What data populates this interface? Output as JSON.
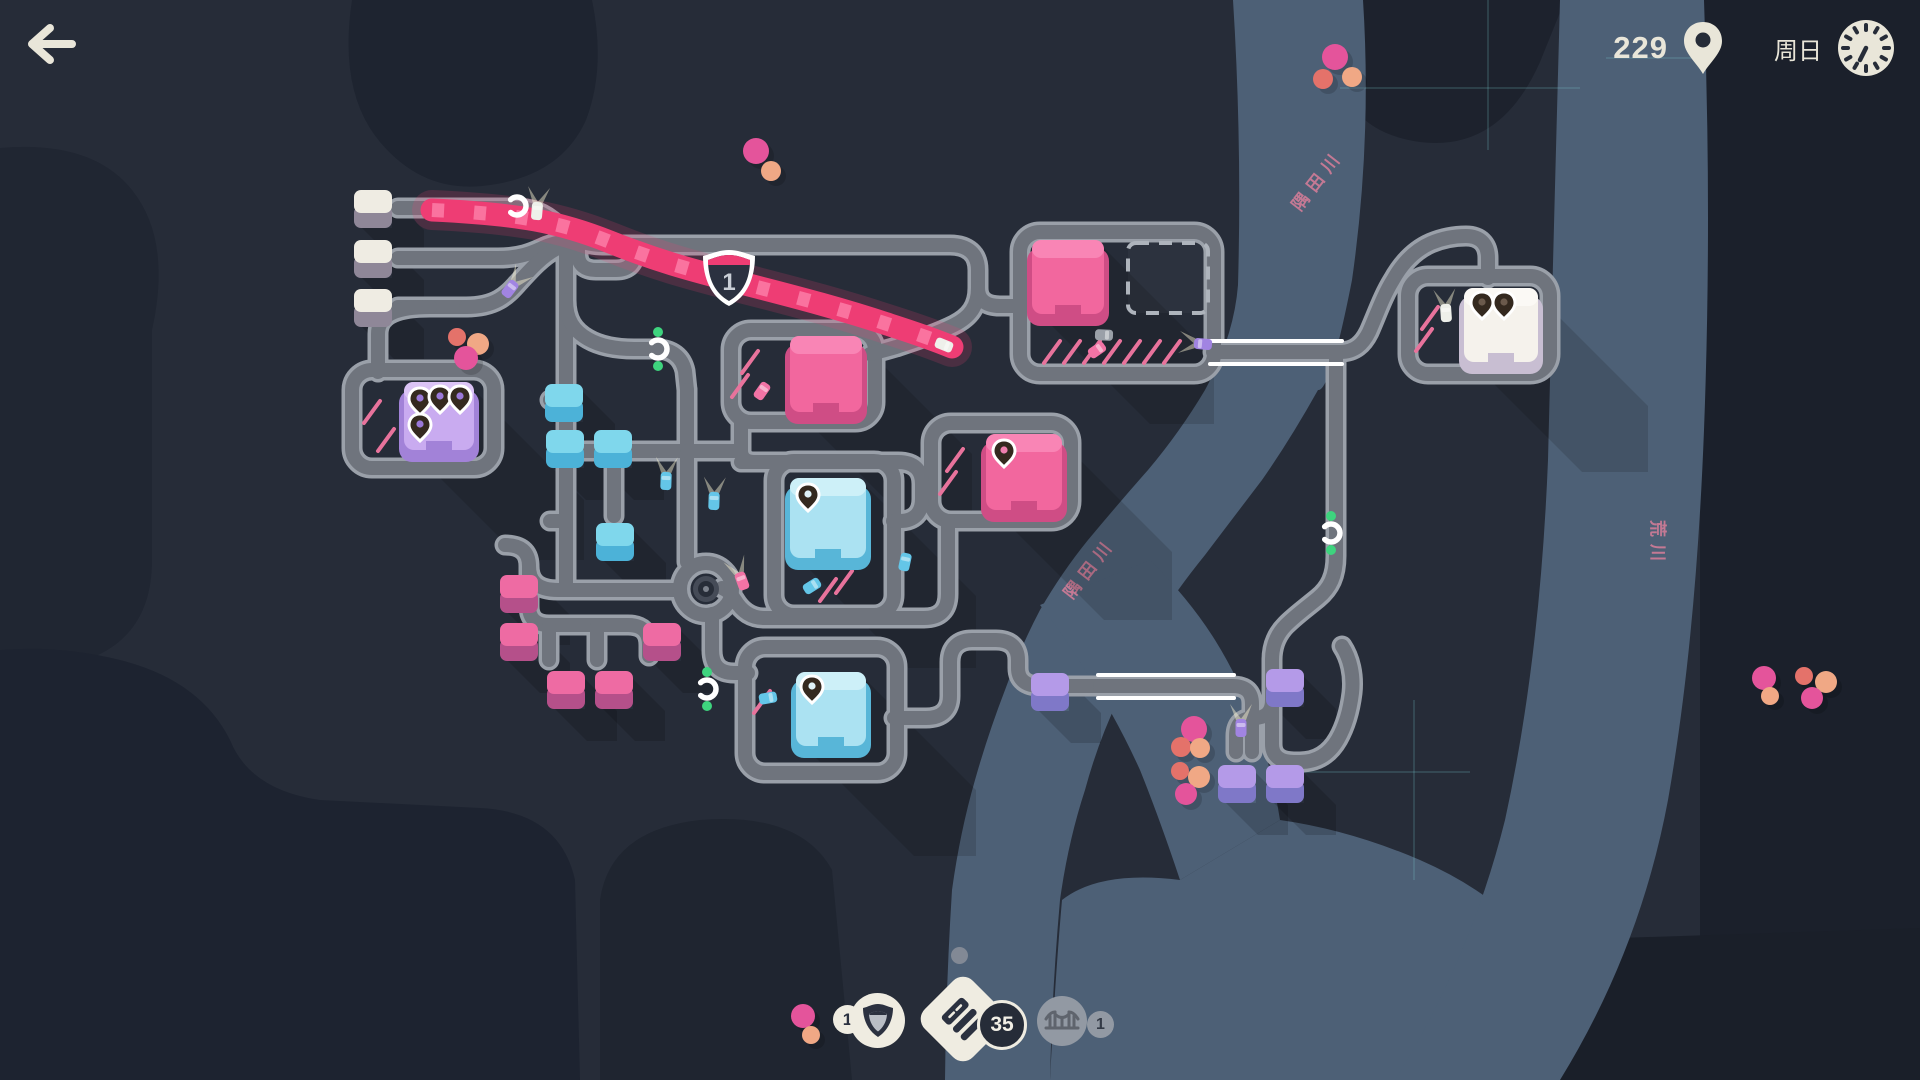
{
  "hud": {
    "score": "229",
    "day": "周日"
  },
  "inventory": {
    "motorway_count": "1",
    "road_count": "35",
    "bridge_count": "1"
  },
  "map": {
    "colors": {
      "bg": "#262c38",
      "road_edge": "#9aa0a9",
      "road_fill": "#6f747d",
      "river": "#4d6076",
      "motorway": "#ee3d74",
      "motorway_stripe": "#ff8ab2",
      "curb": "#ffffff",
      "grid": "#7fd9dd",
      "label": "#e2809c",
      "green": "#3ed47e",
      "dot_pink": "#e4549b",
      "dot_salmon": "#e4726a",
      "dot_peach": "#f0a885"
    },
    "bg_patches": [
      {
        "d": "M352 0 Q338 92 380 142 Q422 192 482 186 Q560 178 586 120 Q606 68 592 0 Z",
        "f": "#1e2430"
      },
      {
        "d": "M0 148 Q92 140 132 190 Q172 240 152 330 L152 560 Q152 640 80 662 L0 682 Z",
        "f": "#202632"
      },
      {
        "d": "M0 650 Q60 645 120 660 Q200 680 230 740 Q250 790 320 800 L480 808 Q560 812 575 880 L580 1080 L0 1080 Z",
        "f": "#1d2330"
      },
      {
        "d": "M600 1080 L600 900 Q610 830 700 820 Q800 812 832 870 L852 1080 Z",
        "f": "#1f2530"
      },
      {
        "d": "M1336 0 L1565 0 L1540 62 Q1500 152 1420 142 Q1348 132 1340 70 Z",
        "f": "#1d222d"
      },
      {
        "d": "M1700 0 H1920 V1080 H1700 Z",
        "f": "#1b202b"
      },
      {
        "d": "M1430 1080 Q1520 1000 1560 940 L1920 928 V1080 Z",
        "f": "#1a1f29"
      }
    ],
    "rivers": [
      {
        "d": "M1233 0 L1363 0 Q1372 140 1352 280 Q1330 392 1318 390 Q1290 440 1262 480 Q1230 522 1205 555 Q1175 592 1155 625 Q1132 662 1118 700 Q1098 742 1085 790 Q1068 842 1060 900 Q1052 990 1050 1080 L945 1080 Q946 985 952 890 Q960 832 975 780 Q988 734 1005 690 Q1020 648 1040 610 Q1062 572 1088 540 Q1118 504 1148 470 Q1180 432 1205 390 Q1234 336 1238 285 Q1242 142 1233 0 Z"
      },
      {
        "d": "M1150 560 Q1190 600 1215 640 Q1240 680 1258 730 Q1272 770 1280 820 L1180 880 Q1160 820 1140 770 Q1115 715 1085 670 Q1060 630 1040 605 Z"
      },
      {
        "d": "M1280 820 Q1350 830 1420 860 Q1500 895 1540 950 Q1490 1020 1430 1080 L1050 1080 Q1055 980 1062 900 Q1100 870 1180 880 Z"
      },
      {
        "d": "M1560 0 H1704 Q1712 220 1704 430 Q1696 640 1668 800 Q1640 950 1560 1080 L1395 1080 Q1470 960 1505 820 Q1540 660 1548 460 Q1554 220 1560 0 Z"
      }
    ],
    "grid_lines": [
      [
        1488,
        0,
        1488,
        150
      ],
      [
        1340,
        88,
        1580,
        88
      ],
      [
        1414,
        700,
        1414,
        880
      ],
      [
        1300,
        772,
        1470,
        772
      ],
      [
        1606,
        58,
        1712,
        58
      ]
    ],
    "river_labels": [
      {
        "text": "隅田川",
        "x": 1300,
        "y": 212,
        "rot": -52
      },
      {
        "text": "隅田川",
        "x": 1072,
        "y": 600,
        "rot": -52
      },
      {
        "text": "荒川",
        "x": 1652,
        "y": 520,
        "rot": 90
      }
    ],
    "roads": [
      "M 398 208 H 514",
      "M 398 258 H 498",
      "M 398 307 H 466",
      "M 514 208 C 544 208 554 223 568 234 C 580 243 592 245 604 245",
      "M 498 258 C 524 258 535 251 547 246 C 558 242 566 241 578 242",
      "M 466 307 C 496 307 507 295 517 284 C 529 271 541 257 556 249",
      "M 430 307 C 400 307 378 313 378 334 L 378 372",
      "M 604 245 H 950 C 968 245 978 254 978 270 V 288 C 978 306 970 317 954 325 C 936 334 914 341 896 347 C 886 350 878 352 870 354",
      "M 978 288 C 978 300 986 306 1000 306 L 1022 306",
      "M 578 245 V 254 C 578 265 585 270 596 270 H 616 C 628 270 634 264 634 254 V 246",
      "M 566 240 V 585",
      "M 566 300 C 566 320 574 331 588 339 C 602 347 618 349 634 349 H 656 C 672 349 682 357 685 371 L 687 390",
      "M 566 451 H 687",
      "M 687 390 V 562",
      "M 741 420 V 450 C 741 458 746 462 754 462",
      "M 566 400 H 550",
      "M 566 521 H 550",
      "M 614 451 V 516",
      "M 687 451 H 741",
      "M 741 462 H 898 C 914 462 922 470 922 484 V 499 C 922 513 914 521 900 521 L 893 521",
      "M 948 521 V 594 C 948 610 940 618 924 618 H 764 C 750 618 741 610 735 600 C 731 594 727 590 722 588",
      "M 712 614 V 650 C 712 666 720 673 734 673 L 748 673",
      "M 680 590 H 558 C 537 590 529 581 529 566 C 529 551 520 545 505 545",
      "M 529 566 V 606 C 529 619 536 625 549 625 H 628 C 642 625 649 632 649 645 L 649 656",
      "M 549 625 V 660",
      "M 597 625 V 660",
      "M 1213 352 H 1340",
      "M 1340 352 C 1355 352 1363 344 1369 332 C 1377 314 1383 296 1393 280 C 1403 262 1415 250 1431 243 C 1443 238 1455 236 1466 236 C 1480 236 1488 244 1488 258 L 1488 278",
      "M 1336 352 V 556 C 1336 576 1330 588 1318 598 C 1306 608 1296 615 1286 625 C 1276 635 1272 647 1272 660",
      "M 1272 660 V 744 C 1272 756 1280 762 1294 762 H 1300 C 1318 762 1330 753 1338 739 C 1346 725 1350 709 1352 693 C 1354 675 1350 658 1342 646",
      "M 1272 700 C 1272 712 1266 718 1254 718 C 1242 718 1236 724 1236 736 V 752",
      "M 894 718 H 926 C 942 718 950 710 950 696 V 662 C 950 648 958 640 972 640 H 996 C 1010 640 1018 647 1018 660 V 668 C 1018 680 1026 686 1040 686 H 1100",
      "M 1100 686 H 1232",
      "M 1232 686 C 1246 686 1252 692 1252 704 V 752"
    ],
    "lots": [
      [
        352,
        370,
        142,
        98
      ],
      [
        731,
        330,
        144,
        92
      ],
      [
        931,
        423,
        140,
        98
      ],
      [
        1020,
        232,
        194,
        142
      ],
      [
        774,
        461,
        120,
        154
      ],
      [
        745,
        647,
        152,
        126
      ],
      [
        1408,
        276,
        142,
        98
      ]
    ],
    "bridges": [
      [
        1210,
        341,
        1342,
        341
      ],
      [
        1210,
        364,
        1342,
        364
      ],
      [
        1098,
        675,
        1234,
        675
      ],
      [
        1098,
        698,
        1234,
        698
      ]
    ],
    "motorway": {
      "path": "M 432 210 C 520 214 560 222 610 242 C 665 264 700 272 745 284 C 800 298 845 310 890 325 C 915 333 935 340 952 347",
      "shield": {
        "x": 729,
        "y": 277,
        "label": "1"
      }
    },
    "dashed_zone": {
      "x": 1128,
      "y": 243,
      "w": 80,
      "h": 70
    },
    "deco_dashes": [
      [
        372,
        412
      ],
      [
        386,
        440
      ],
      [
        750,
        362
      ],
      [
        740,
        386
      ],
      [
        955,
        460
      ],
      [
        948,
        483
      ],
      [
        1052,
        352
      ],
      [
        1072,
        352
      ],
      [
        1092,
        352
      ],
      [
        1112,
        352
      ],
      [
        1132,
        352
      ],
      [
        1152,
        352
      ],
      [
        1172,
        352
      ],
      [
        1430,
        318
      ],
      [
        1424,
        340
      ],
      [
        828,
        590
      ],
      [
        844,
        582
      ],
      [
        762,
        702
      ]
    ],
    "roundabout": {
      "x": 706,
      "y": 589
    },
    "houses": [
      [
        354,
        190,
        "gray"
      ],
      [
        354,
        240,
        "gray"
      ],
      [
        354,
        289,
        "gray"
      ],
      [
        545,
        384,
        "blue"
      ],
      [
        546,
        430,
        "blue"
      ],
      [
        594,
        430,
        "blue"
      ],
      [
        596,
        523,
        "blue"
      ],
      [
        500,
        575,
        "pink"
      ],
      [
        500,
        623,
        "pink"
      ],
      [
        547,
        671,
        "pink"
      ],
      [
        595,
        671,
        "pink"
      ],
      [
        643,
        623,
        "pink"
      ],
      [
        1031,
        673,
        "purple"
      ],
      [
        1266,
        669,
        "purple"
      ],
      [
        1218,
        765,
        "purple"
      ],
      [
        1266,
        765,
        "purple"
      ]
    ],
    "house_palette": {
      "gray": [
        "#efece3",
        "#8f8798"
      ],
      "blue": [
        "#7fd7ec",
        "#4cb2d8"
      ],
      "pink": [
        "#ee6ba3",
        "#b5508a"
      ],
      "purple": [
        "#b49ae8",
        "#7f78c8"
      ]
    },
    "destinations": [
      {
        "x": 404,
        "y": 382,
        "w": 70,
        "h": 68,
        "face": "#c9abf0",
        "top": "#dbc4f6",
        "side": "#a282d8",
        "hole": "#9a78d8",
        "pins": [
          [
            16,
            18
          ],
          [
            36,
            16
          ],
          [
            56,
            16
          ],
          [
            16,
            44
          ]
        ]
      },
      {
        "x": 790,
        "y": 336,
        "w": 72,
        "h": 76,
        "face": "#f2679e",
        "top": "#f985b5",
        "side": "#cf4d85",
        "hole": "#ef7fae",
        "pins": []
      },
      {
        "x": 986,
        "y": 434,
        "w": 76,
        "h": 76,
        "face": "#f2679e",
        "top": "#f985b5",
        "side": "#cf4d85",
        "hole": "#ef7fae",
        "pins": [
          [
            18,
            18
          ]
        ]
      },
      {
        "x": 1032,
        "y": 240,
        "w": 72,
        "h": 74,
        "face": "#f2679e",
        "top": "#f985b5",
        "side": "#cf4d85",
        "hole": "#ef7fae",
        "pins": []
      },
      {
        "x": 790,
        "y": 478,
        "w": 76,
        "h": 80,
        "face": "#abe2f2",
        "top": "#cdf0f8",
        "side": "#58b6d8",
        "hole": "#dff2f8",
        "pins": [
          [
            18,
            18
          ]
        ]
      },
      {
        "x": 796,
        "y": 672,
        "w": 70,
        "h": 74,
        "face": "#abe2f2",
        "top": "#cdf0f8",
        "side": "#58b6d8",
        "hole": "#dff2f8",
        "pins": [
          [
            16,
            16
          ]
        ]
      },
      {
        "x": 1464,
        "y": 288,
        "w": 74,
        "h": 74,
        "face": "#f5f2ec",
        "top": "#fbf9f5",
        "side": "#c8bed2",
        "hole": "#6b5a4c",
        "pins": [
          [
            18,
            16
          ],
          [
            40,
            16
          ]
        ]
      }
    ],
    "cars": [
      [
        537,
        211,
        5,
        "white",
        1
      ],
      [
        510,
        289,
        38,
        "purple",
        1
      ],
      [
        944,
        345,
        112,
        "white",
        0
      ],
      [
        1104,
        335,
        92,
        "gray",
        0
      ],
      [
        1097,
        350,
        55,
        "pink",
        0
      ],
      [
        1203,
        344,
        -85,
        "purple",
        1
      ],
      [
        666,
        481,
        2,
        "blue",
        1
      ],
      [
        714,
        501,
        2,
        "blue",
        1
      ],
      [
        762,
        391,
        35,
        "pink",
        0
      ],
      [
        742,
        581,
        -20,
        "pink",
        1
      ],
      [
        905,
        562,
        12,
        "blue",
        0
      ],
      [
        812,
        586,
        58,
        "blue",
        0
      ],
      [
        1446,
        313,
        -4,
        "white",
        1
      ],
      [
        1241,
        728,
        0,
        "purple",
        1
      ],
      [
        768,
        698,
        80,
        "blue",
        0
      ]
    ],
    "car_palette": {
      "white": "#eef0ea",
      "gray": "#9aa0a8",
      "pink": "#f273a5",
      "purple": "#a184e2",
      "blue": "#64c6e8"
    },
    "traffic_lights": [
      {
        "x": 658,
        "y": 349,
        "g": [
          [
            0,
            -17
          ],
          [
            0,
            17
          ]
        ]
      },
      {
        "x": 707,
        "y": 689,
        "g": [
          [
            0,
            -17
          ],
          [
            0,
            17
          ]
        ]
      },
      {
        "x": 1331,
        "y": 533,
        "g": [
          [
            0,
            -17
          ],
          [
            0,
            17
          ]
        ]
      },
      {
        "x": 517,
        "y": 206,
        "g": []
      }
    ],
    "dots": [
      [
        756,
        151,
        13,
        "pink"
      ],
      [
        771,
        171,
        10,
        "peach"
      ],
      [
        1335,
        57,
        13,
        "pink"
      ],
      [
        1352,
        77,
        10,
        "peach"
      ],
      [
        1323,
        79,
        10,
        "salmon"
      ],
      [
        457,
        337,
        9,
        "salmon"
      ],
      [
        478,
        344,
        11,
        "peach"
      ],
      [
        466,
        358,
        12,
        "pink"
      ],
      [
        1194,
        729,
        13,
        "pink"
      ],
      [
        1181,
        747,
        10,
        "salmon"
      ],
      [
        1200,
        748,
        10,
        "peach"
      ],
      [
        1180,
        771,
        9,
        "salmon"
      ],
      [
        1199,
        777,
        11,
        "peach"
      ],
      [
        1186,
        794,
        11,
        "pink"
      ],
      [
        1764,
        678,
        12,
        "pink"
      ],
      [
        1770,
        696,
        9,
        "peach"
      ],
      [
        1804,
        676,
        9,
        "salmon"
      ],
      [
        1826,
        682,
        11,
        "peach"
      ],
      [
        1812,
        698,
        11,
        "pink"
      ],
      [
        803,
        1016,
        12,
        "pink"
      ],
      [
        811,
        1035,
        9,
        "peach"
      ]
    ]
  }
}
